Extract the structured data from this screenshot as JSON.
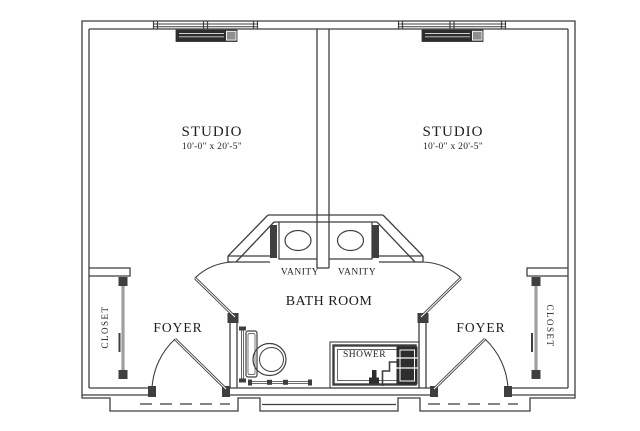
{
  "plan": {
    "background": "#ffffff",
    "line_color": "#3f3f3f",
    "fixture_dark": "#2d2d2d",
    "labels": {
      "studio_left": "STUDIO",
      "studio_left_dims": "10'-0\" x 20'-5\"",
      "studio_right": "STUDIO",
      "studio_right_dims": "10'-0\" x 20'-5\"",
      "vanity_left": "VANITY",
      "vanity_right": "VANITY",
      "bathroom": "BATH ROOM",
      "shower": "SHOWER",
      "foyer_left": "FOYER",
      "foyer_right": "FOYER",
      "closet_left": "CLOSET",
      "closet_right": "CLOSET"
    }
  }
}
